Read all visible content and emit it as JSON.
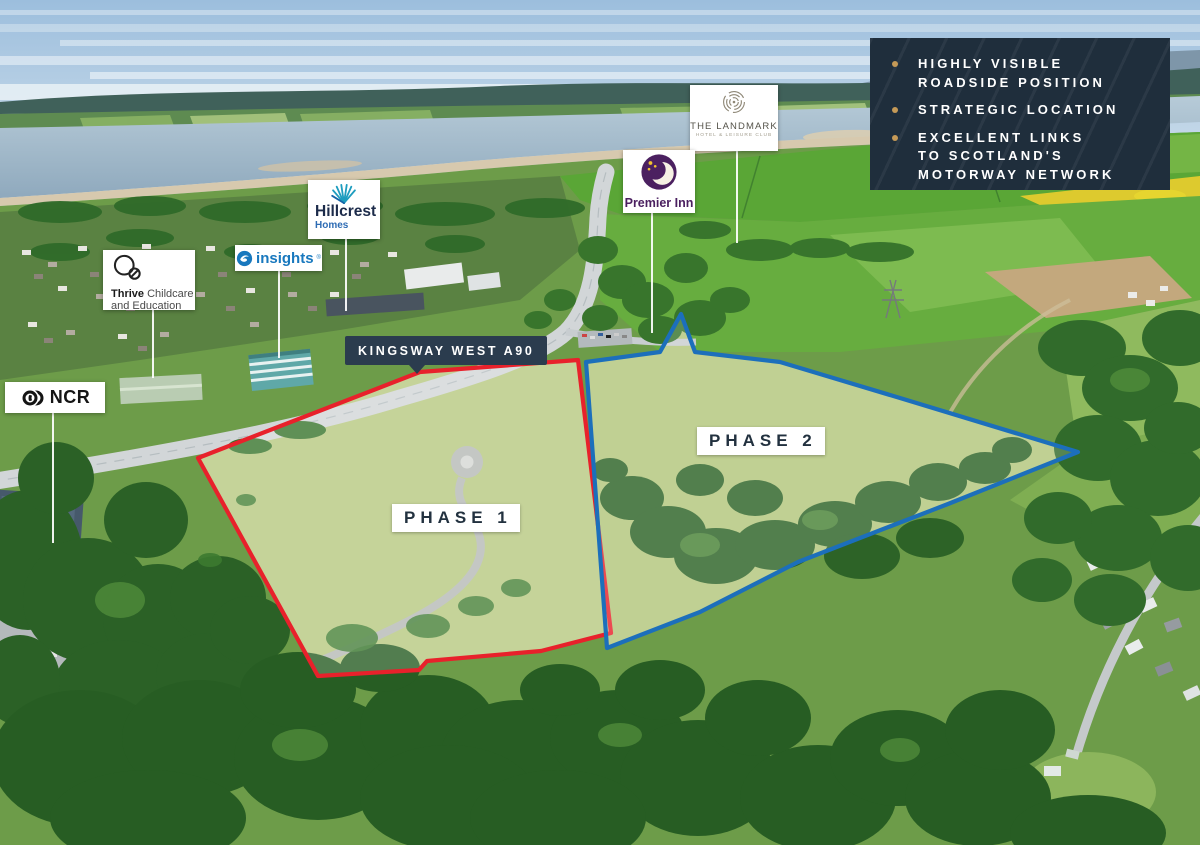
{
  "features": {
    "bg_color": "#1f2e3c",
    "bullet_color": "#c59a57",
    "items": [
      [
        "HIGHLY VISIBLE",
        "ROADSIDE POSITION"
      ],
      [
        "STRATEGIC LOCATION"
      ],
      [
        "EXCELLENT LINKS",
        "TO SCOTLAND'S",
        "MOTORWAY NETWORK"
      ]
    ]
  },
  "road_label": {
    "text": "KINGSWAY WEST A90"
  },
  "phases": [
    {
      "label": "PHASE 1",
      "color": "#e8212b"
    },
    {
      "label": "PHASE 2",
      "color": "#1c6fbb"
    }
  ],
  "logos": {
    "landmark": {
      "title": "THE LANDMARK",
      "subtitle": "HOTEL & LEISURE CLUB"
    },
    "premier": {
      "label": "Premier Inn"
    },
    "hillcrest": {
      "title": "Hillcrest",
      "subtitle": "Homes"
    },
    "insights": {
      "label": "insights",
      "trademark": "®"
    },
    "thrive": {
      "bold": "Thrive",
      "rest": " Childcare",
      "line2": "and Education"
    },
    "ncr": {
      "label": "NCR"
    }
  }
}
